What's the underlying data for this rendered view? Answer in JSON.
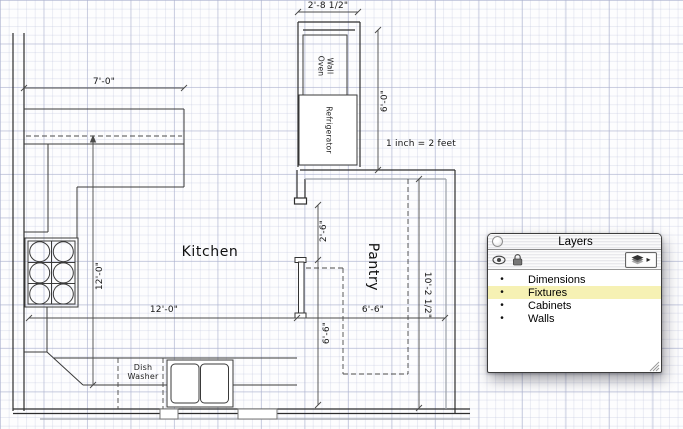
{
  "scale_note": "1 inch = 2 feet",
  "rooms": {
    "kitchen": "Kitchen",
    "pantry": "Pantry"
  },
  "fixtures": {
    "wall_oven_line1": "Wall",
    "wall_oven_line2": "Oven",
    "refrigerator": "Refrigerator",
    "dish_washer_line1": "Dish",
    "dish_washer_line2": "Washer"
  },
  "dimensions": {
    "alcove_width": "2'-8 1/2\"",
    "alcove_height": "6'-0\"",
    "upper_cabinets": "7'-0\"",
    "kitchen_width": "12'-0\"",
    "kitchen_depth": "12'-0\"",
    "pantry_width": "6'-6\"",
    "pantry_depth_inner": "6'-6\"",
    "pantry_height": "10'-2 1/2\"",
    "door_opening": "2'-6\""
  },
  "palette": {
    "title": "Layers",
    "menu_arrow": "▸",
    "highlight_color": "#F6F1B4",
    "rows": [
      {
        "bullet": "•",
        "label": "Dimensions",
        "highlighted": false
      },
      {
        "bullet": "•",
        "label": "Fixtures",
        "highlighted": true
      },
      {
        "bullet": "•",
        "label": "Cabinets",
        "highlighted": false
      },
      {
        "bullet": "•",
        "label": "Walls",
        "highlighted": false
      }
    ]
  }
}
